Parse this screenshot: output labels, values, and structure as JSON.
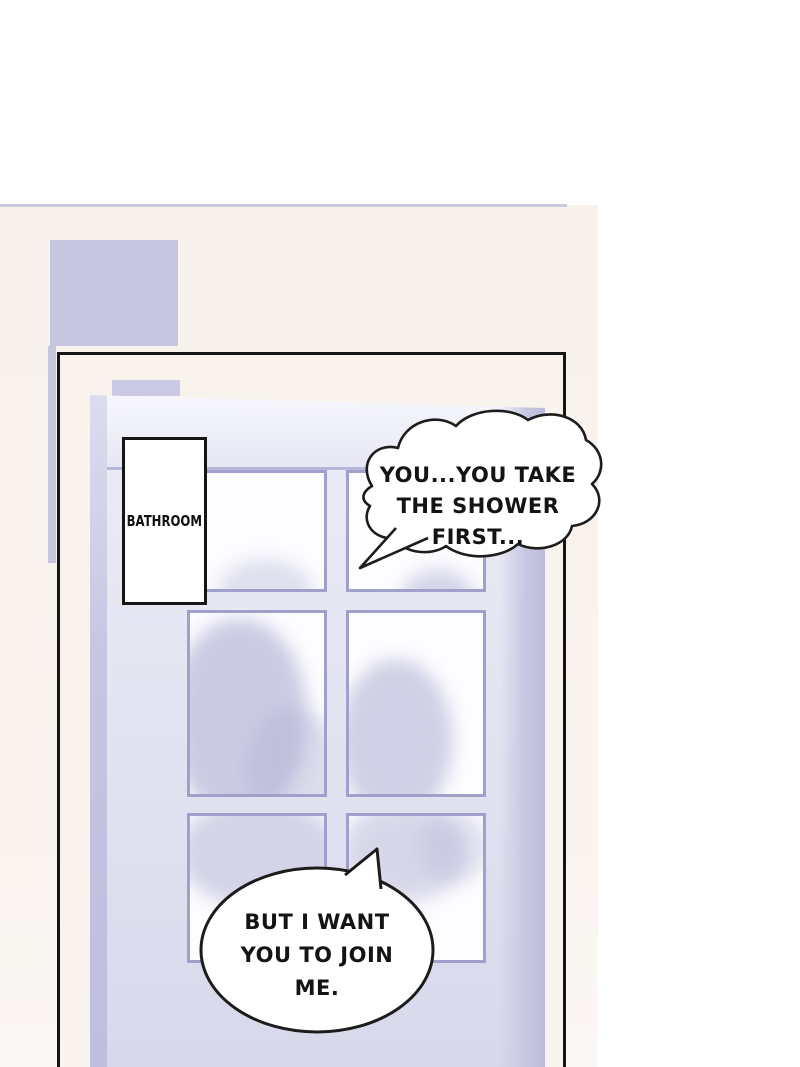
{
  "sign": {
    "label": "BATHROOM"
  },
  "speech": [
    {
      "name": "shower-first",
      "lines": [
        "YOU...YOU TAKE",
        "THE SHOWER",
        "FIRST..."
      ]
    },
    {
      "name": "join-me",
      "lines": [
        "BUT I WANT",
        "YOU TO JOIN",
        "ME."
      ]
    }
  ],
  "colors": {
    "backdrop-pink": "#f8f1ec",
    "panel-bg": "#f9f3ee",
    "divider": "#c9c9da",
    "accent-lavender": "#c6c6e1",
    "door-face-deep": "#d8d8ec",
    "pane-border": "#a0a0ca",
    "pane-glass": "#fdfdff",
    "silhouette": "#b3b3d6",
    "outline": "#151515"
  }
}
